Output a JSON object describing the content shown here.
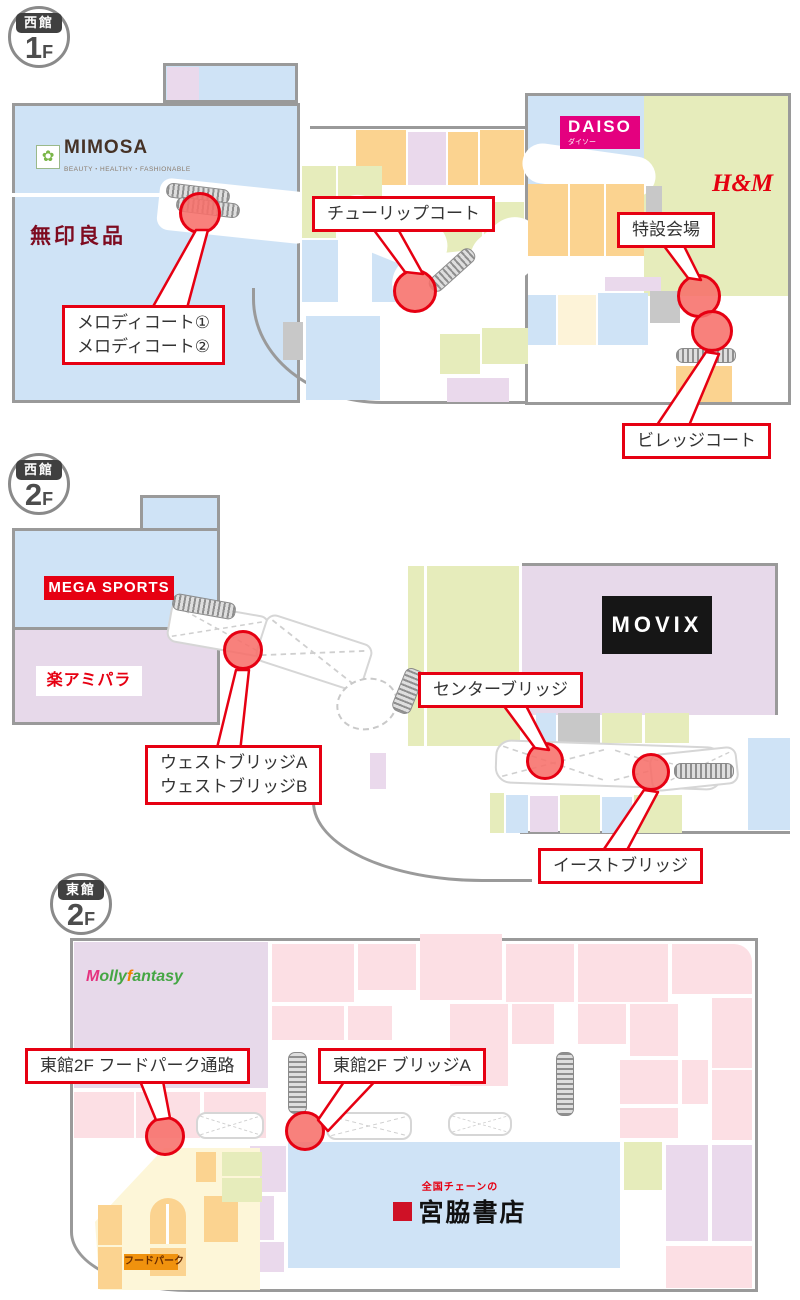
{
  "page": {
    "background": "#ffffff"
  },
  "colors": {
    "marker_fill": "#f7706a",
    "marker_border": "#e60012",
    "callout_border": "#e60012",
    "outline_gray": "#9a9a9a",
    "block_blue": "#cfe3f6",
    "block_green": "#e6ecbb",
    "block_orange": "#fbd390",
    "block_lavender": "#ead9ec",
    "block_pink": "#fcdfe4",
    "block_purple": "#e7d9ea"
  },
  "sections": [
    {
      "id": "west-1f",
      "badge": {
        "building": "西館",
        "floor_number": "1",
        "floor_suffix": "F"
      },
      "stores": {
        "mimosa": {
          "name": "MIMOSA",
          "tagline": "BEAUTY・HEALTHY・FASHIONABLE"
        },
        "muji": {
          "name": "無印良品"
        },
        "daiso": {
          "name": "DAISO",
          "sub": "ダイソー"
        },
        "hm": {
          "name": "H&M"
        }
      },
      "callouts": {
        "melody": {
          "line1": "メロディコート①",
          "line2": "メロディコート②"
        },
        "tulip": {
          "line1": "チューリップコート"
        },
        "special": {
          "line1": "特設会場"
        },
        "village": {
          "line1": "ビレッジコート"
        }
      }
    },
    {
      "id": "west-2f",
      "badge": {
        "building": "西館",
        "floor_number": "2",
        "floor_suffix": "F"
      },
      "stores": {
        "mega_sports": {
          "name": "MEGA SPORTS"
        },
        "amipara": {
          "name": "楽アミパラ"
        },
        "movix": {
          "name": "MOVIX"
        }
      },
      "callouts": {
        "center": {
          "line1": "センターブリッジ"
        },
        "west": {
          "line1": "ウェストブリッジA",
          "line2": "ウェストブリッジB"
        },
        "east": {
          "line1": "イーストブリッジ"
        }
      }
    },
    {
      "id": "east-2f",
      "badge": {
        "building": "東館",
        "floor_number": "2",
        "floor_suffix": "F"
      },
      "stores": {
        "mollyfantasy": {
          "name_p1": "M",
          "name_p2": "olly",
          "name_p3": "f",
          "name_p4": "antasy"
        },
        "miyawaki": {
          "name": "宮脇書店",
          "sub": "全国チェーンの"
        },
        "foodpark": {
          "name": "フードパーク"
        }
      },
      "callouts": {
        "foodpark_passage": {
          "line1": "東館2F フードパーク通路"
        },
        "bridge_a": {
          "line1": "東館2F ブリッジA"
        }
      }
    }
  ]
}
